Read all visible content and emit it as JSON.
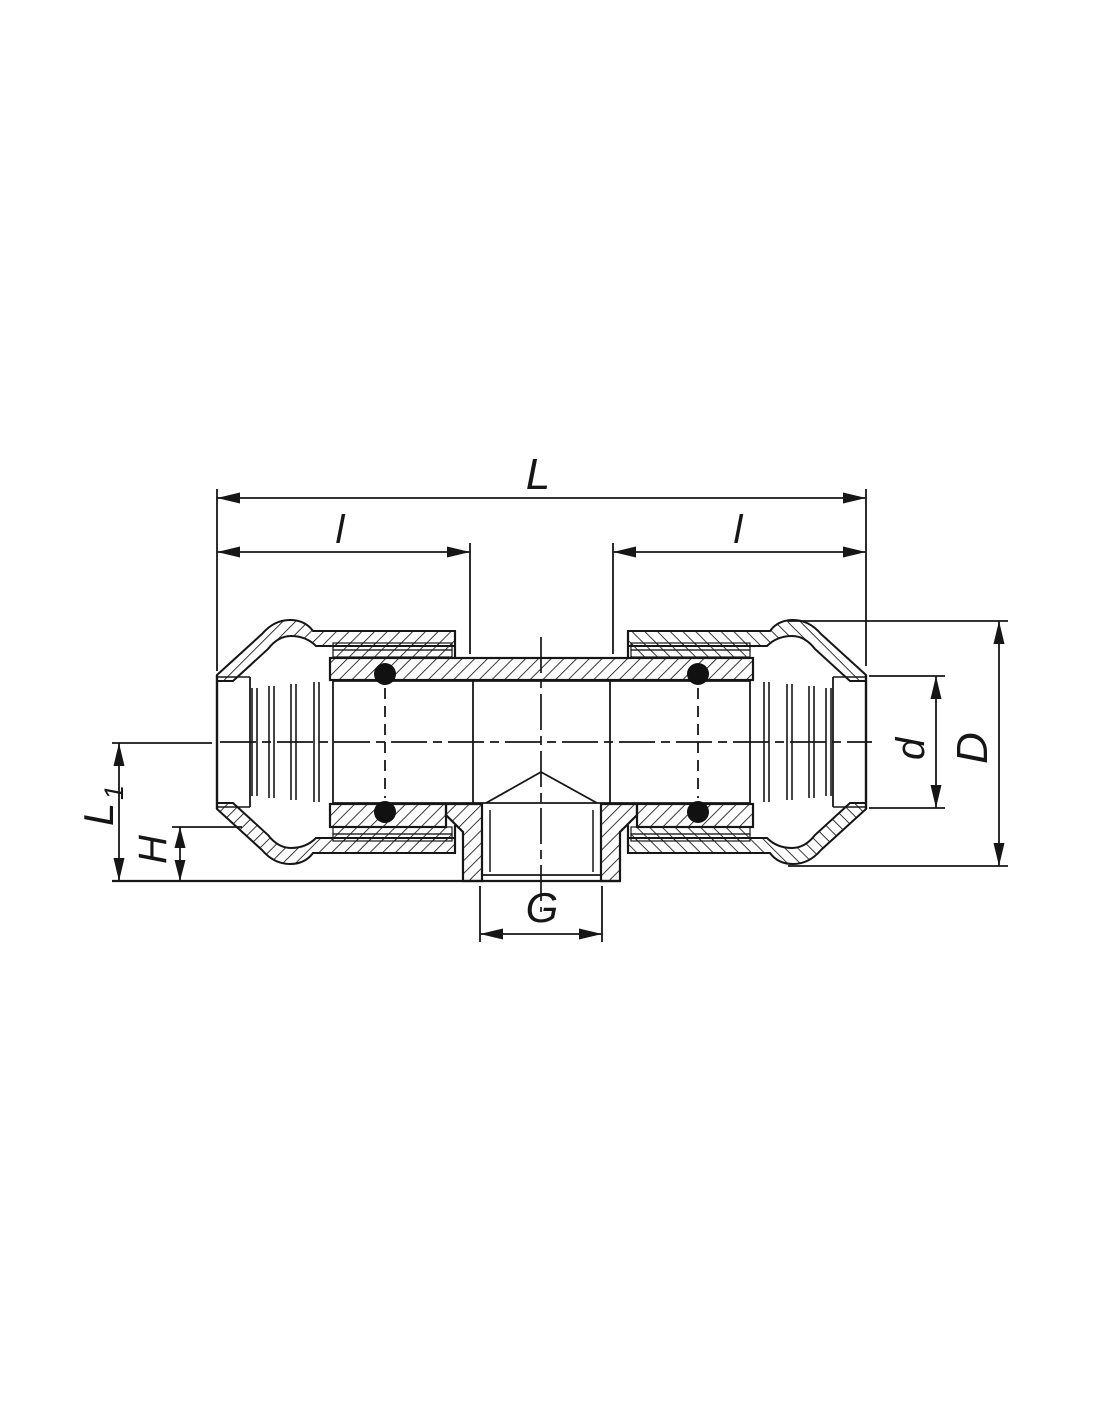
{
  "drawing": {
    "description": "Cross-section technical drawing of a compression tee fitting with female threaded branch",
    "background_color": "#ffffff",
    "line_color": "#161616",
    "dimension_labels": {
      "overall_length": "L",
      "left_engagement": "l",
      "right_engagement": "l",
      "branch_height_main": "L",
      "branch_height_sub": "1",
      "stub_height": "H",
      "branch_thread": "G",
      "pipe_bore_diameter": "d",
      "outer_diameter": "D"
    }
  }
}
